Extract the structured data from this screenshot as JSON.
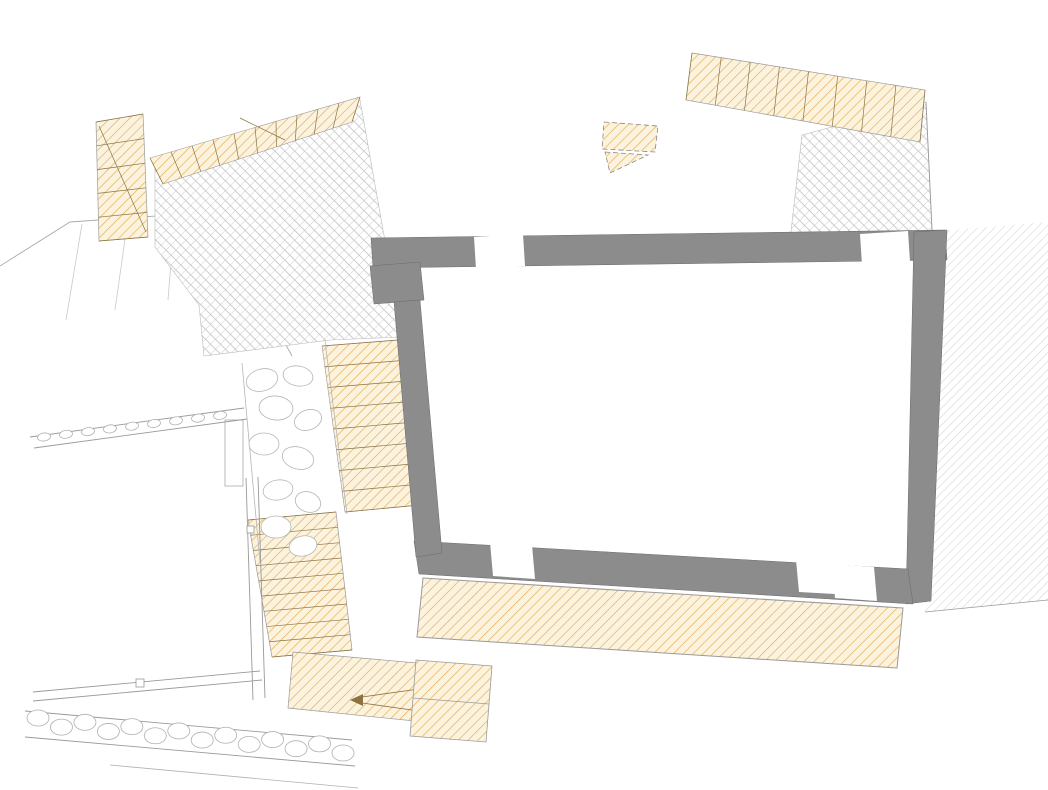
{
  "drawing": {
    "type": "architectural-floor-plan"
  },
  "colors": {
    "new_wall": "#F9AE00",
    "existing_wall": "#8C8C8C",
    "hatch_line": "#E0AC55",
    "hatch_bg": "#FCF3DF",
    "paving_line": "#C8C8C8",
    "adjacent_hatch": "#CED3D8",
    "thin_line": "#9a9a9a",
    "dim_text": "#2b2b33",
    "text": "#1f1f1f"
  },
  "rooms": [
    {
      "name": "room-cucina",
      "lines": [
        "Cucina",
        "4.9 m²"
      ],
      "x": 470,
      "y": 177
    },
    {
      "name": "room-soggiorno",
      "lines": [
        "Soggiorno",
        "10.5 m²"
      ],
      "x": 500,
      "y": 433
    },
    {
      "name": "room-bagno",
      "lines": [
        "Bagno",
        "3.1 m²"
      ],
      "x": 679,
      "y": 333
    },
    {
      "name": "room-monolocale",
      "lines": [
        "Monolocale",
        "21.5 m²"
      ],
      "x": 755,
      "y": 440
    },
    {
      "name": "room-balcone",
      "lines": [
        "Balcone"
      ],
      "x": 637,
      "y": 623
    },
    {
      "name": "zone-terrazza-coperta",
      "lines": [
        "Terrazza",
        "coperta"
      ],
      "x": 236,
      "y": 221
    }
  ],
  "zones": [
    {
      "name": "zone-verde-top-left",
      "text": "Verde",
      "x": 230,
      "y": 14,
      "size": 16
    },
    {
      "name": "zone-verde-top-right",
      "text": "Verde",
      "x": 852,
      "y": 11,
      "size": 16
    },
    {
      "name": "zone-verde-left",
      "text": "Verde",
      "x": 54,
      "y": 377,
      "size": 16
    },
    {
      "name": "zone-verde-bottom",
      "text": "Verde",
      "x": 116,
      "y": 572,
      "size": 16
    },
    {
      "name": "zone-altra",
      "text": "altra",
      "x": 1030,
      "y": 444,
      "size": 15
    },
    {
      "name": "zone-autobloccanti",
      "text": "autoblo",
      "x": 1028,
      "y": 10,
      "size": 11
    }
  ],
  "annotations": [
    {
      "name": "note-pavimentazione",
      "lines": [
        "Pavimentazione in",
        "autobloccanti da rimuovere"
      ],
      "x": 8,
      "y": 288,
      "size": 12.5,
      "anchor": "start"
    },
    {
      "name": "note-muro-pietrame",
      "lines": [
        "muro in pietrame"
      ],
      "x": 107,
      "y": 441,
      "size": 12.5,
      "rotate": -9
    },
    {
      "name": "note-aiuola-1",
      "lines": [
        "Aiuola"
      ],
      "x": 233,
      "y": 447,
      "size": 8.5,
      "rotate": -90
    },
    {
      "name": "note-aiuola-2",
      "lines": [
        "Aiuola"
      ],
      "x": 331,
      "y": 481,
      "size": 8.5,
      "rotate": -80
    }
  ],
  "dimensions": [
    {
      "v": "340",
      "x": 462,
      "y": 64
    },
    {
      "v": "260",
      "x": 467,
      "y": 147
    },
    {
      "v": "640",
      "x": 757,
      "y": 194
    },
    {
      "v": "95",
      "x": 436,
      "y": 303
    },
    {
      "v": "145",
      "x": 508,
      "y": 301
    },
    {
      "v": "285",
      "x": 678,
      "y": 301
    },
    {
      "v": "250",
      "x": 838,
      "y": 299
    },
    {
      "v": "225",
      "x": 518,
      "y": 509
    },
    {
      "v": "480",
      "x": 765,
      "y": 524
    },
    {
      "v": "185",
      "x": 460,
      "y": 660
    },
    {
      "v": "395",
      "x": 628,
      "y": 675
    },
    {
      "v": "180",
      "x": 794,
      "y": 689
    },
    {
      "v": "135",
      "x": 885,
      "y": 696
    },
    {
      "v": "900",
      "x": 664,
      "y": 705
    },
    {
      "v": "5",
      "x": 471,
      "y": 321
    },
    {
      "v": "5",
      "x": 777,
      "y": 317
    },
    {
      "v": "105",
      "x": 252,
      "y": 144,
      "r": 75
    },
    {
      "v": "240",
      "x": 284,
      "y": 193,
      "r": 75
    },
    {
      "v": "90",
      "x": 322,
      "y": 196,
      "r": 70
    },
    {
      "v": "50",
      "x": 331,
      "y": 223,
      "r": 70
    },
    {
      "v": "125",
      "x": 297,
      "y": 288,
      "r": 75
    },
    {
      "v": "240",
      "x": 594,
      "y": 173,
      "r": 72
    },
    {
      "v": "195",
      "x": 531,
      "y": 191,
      "r": 80
    },
    {
      "v": "450",
      "x": 459,
      "y": 406,
      "r": 75
    },
    {
      "v": "465",
      "x": 541,
      "y": 417,
      "r": 78
    },
    {
      "v": "470",
      "x": 644,
      "y": 407,
      "r": 78
    },
    {
      "v": "505",
      "x": 868,
      "y": 425,
      "r": 80
    },
    {
      "v": "570",
      "x": 291,
      "y": 418,
      "r": 80
    },
    {
      "v": "445",
      "x": 322,
      "y": 451,
      "r": 72
    },
    {
      "v": "110",
      "x": 915,
      "y": 641,
      "r": 62
    }
  ],
  "fractions": [
    {
      "t": "0.60",
      "b": "0.80",
      "x": 352,
      "y": 164,
      "r": -12
    },
    {
      "t": "0.70",
      "b": "2.10",
      "x": 356,
      "y": 217,
      "r": -10
    },
    {
      "t": "0.60",
      "b": "0.80",
      "x": 357,
      "y": 316,
      "r": -8
    },
    {
      "t": "0.70",
      "b": "2.10",
      "x": 884,
      "y": 219,
      "r": -90
    },
    {
      "t": "0.70",
      "b": "1.80",
      "x": 495,
      "y": 265,
      "r": -90
    },
    {
      "t": "0.70",
      "b": "2.10",
      "x": 731,
      "y": 374,
      "r": -90
    },
    {
      "t": "0.66",
      "b": "1.60",
      "x": 517,
      "y": 589,
      "r": -90
    },
    {
      "t": "0.70",
      "b": "0.90",
      "x": 745,
      "y": 622,
      "r": -90
    },
    {
      "t": "0.70",
      "b": "1.80",
      "x": 850,
      "y": 614,
      "r": -90
    }
  ],
  "elevations": [
    {
      "v": "0.65",
      "cx": 125,
      "cy": 118,
      "tx": 134,
      "ty": 110
    },
    {
      "v": "-0.40",
      "cx": 141,
      "cy": 237,
      "tx": 107,
      "ty": 252,
      "below": true
    },
    {
      "v": "0.93",
      "cx": 362,
      "cy": 92,
      "tx": 371,
      "ty": 85
    },
    {
      "v": "0.97",
      "cx": 561,
      "cy": 91,
      "tx": 570,
      "ty": 84
    },
    {
      "v": "0.77",
      "cx": 688,
      "cy": 87,
      "tx": 650,
      "ty": 79
    },
    {
      "v": "-0.05",
      "cx": 844,
      "cy": 140,
      "tx": 852,
      "ty": 134
    },
    {
      "v": "0.51",
      "cx": 784,
      "cy": 231,
      "tx": 745,
      "ty": 224
    },
    {
      "v": "0.02",
      "cx": 810,
      "cy": 233,
      "tx": 819,
      "ty": 226
    },
    {
      "v": "-0.23",
      "cx": 437,
      "cy": 219,
      "tx": 444,
      "ty": 211
    },
    {
      "v": "-0.48",
      "cx": 319,
      "cy": 303,
      "tx": 327,
      "ty": 296
    },
    {
      "v": "-0.45",
      "cx": 184,
      "cy": 401,
      "tx": 146,
      "ty": 394
    },
    {
      "v": "-2.60",
      "cx": 272,
      "cy": 383,
      "tx": 282,
      "ty": 398,
      "below": true
    },
    {
      "v": "-2.25",
      "cx": 208,
      "cy": 427,
      "tx": 171,
      "ty": 442,
      "below": true
    },
    {
      "v": "-0.13",
      "cx": 481,
      "cy": 479,
      "tx": 489,
      "ty": 472
    },
    {
      "v": "0.00",
      "cx": 730,
      "cy": 488,
      "tx": 739,
      "ty": 481
    },
    {
      "v": "-2.70",
      "cx": 273,
      "cy": 529,
      "tx": 281,
      "ty": 521
    },
    {
      "v": "-2.50",
      "cx": 361,
      "cy": 539,
      "tx": 369,
      "ty": 532
    },
    {
      "v": "-2.40",
      "cx": 237,
      "cy": 681,
      "tx": 200,
      "ty": 675
    },
    {
      "v": "-4.16",
      "cx": 301,
      "cy": 702,
      "tx": 309,
      "ty": 697,
      "dashed": true
    },
    {
      "v": "-5.05",
      "cx": 501,
      "cy": 719,
      "tx": 509,
      "ty": 712
    },
    {
      "v": "0.00",
      "cx": 685,
      "cy": 632,
      "tx": 693,
      "ty": 625
    }
  ],
  "sections": [
    {
      "label": "A",
      "x": 527,
      "y": 10
    },
    {
      "label": "A",
      "x": 528,
      "y": 753
    },
    {
      "label": "B",
      "x": 816,
      "y": 751
    },
    {
      "label": "C",
      "x": 90,
      "y": 360
    }
  ]
}
